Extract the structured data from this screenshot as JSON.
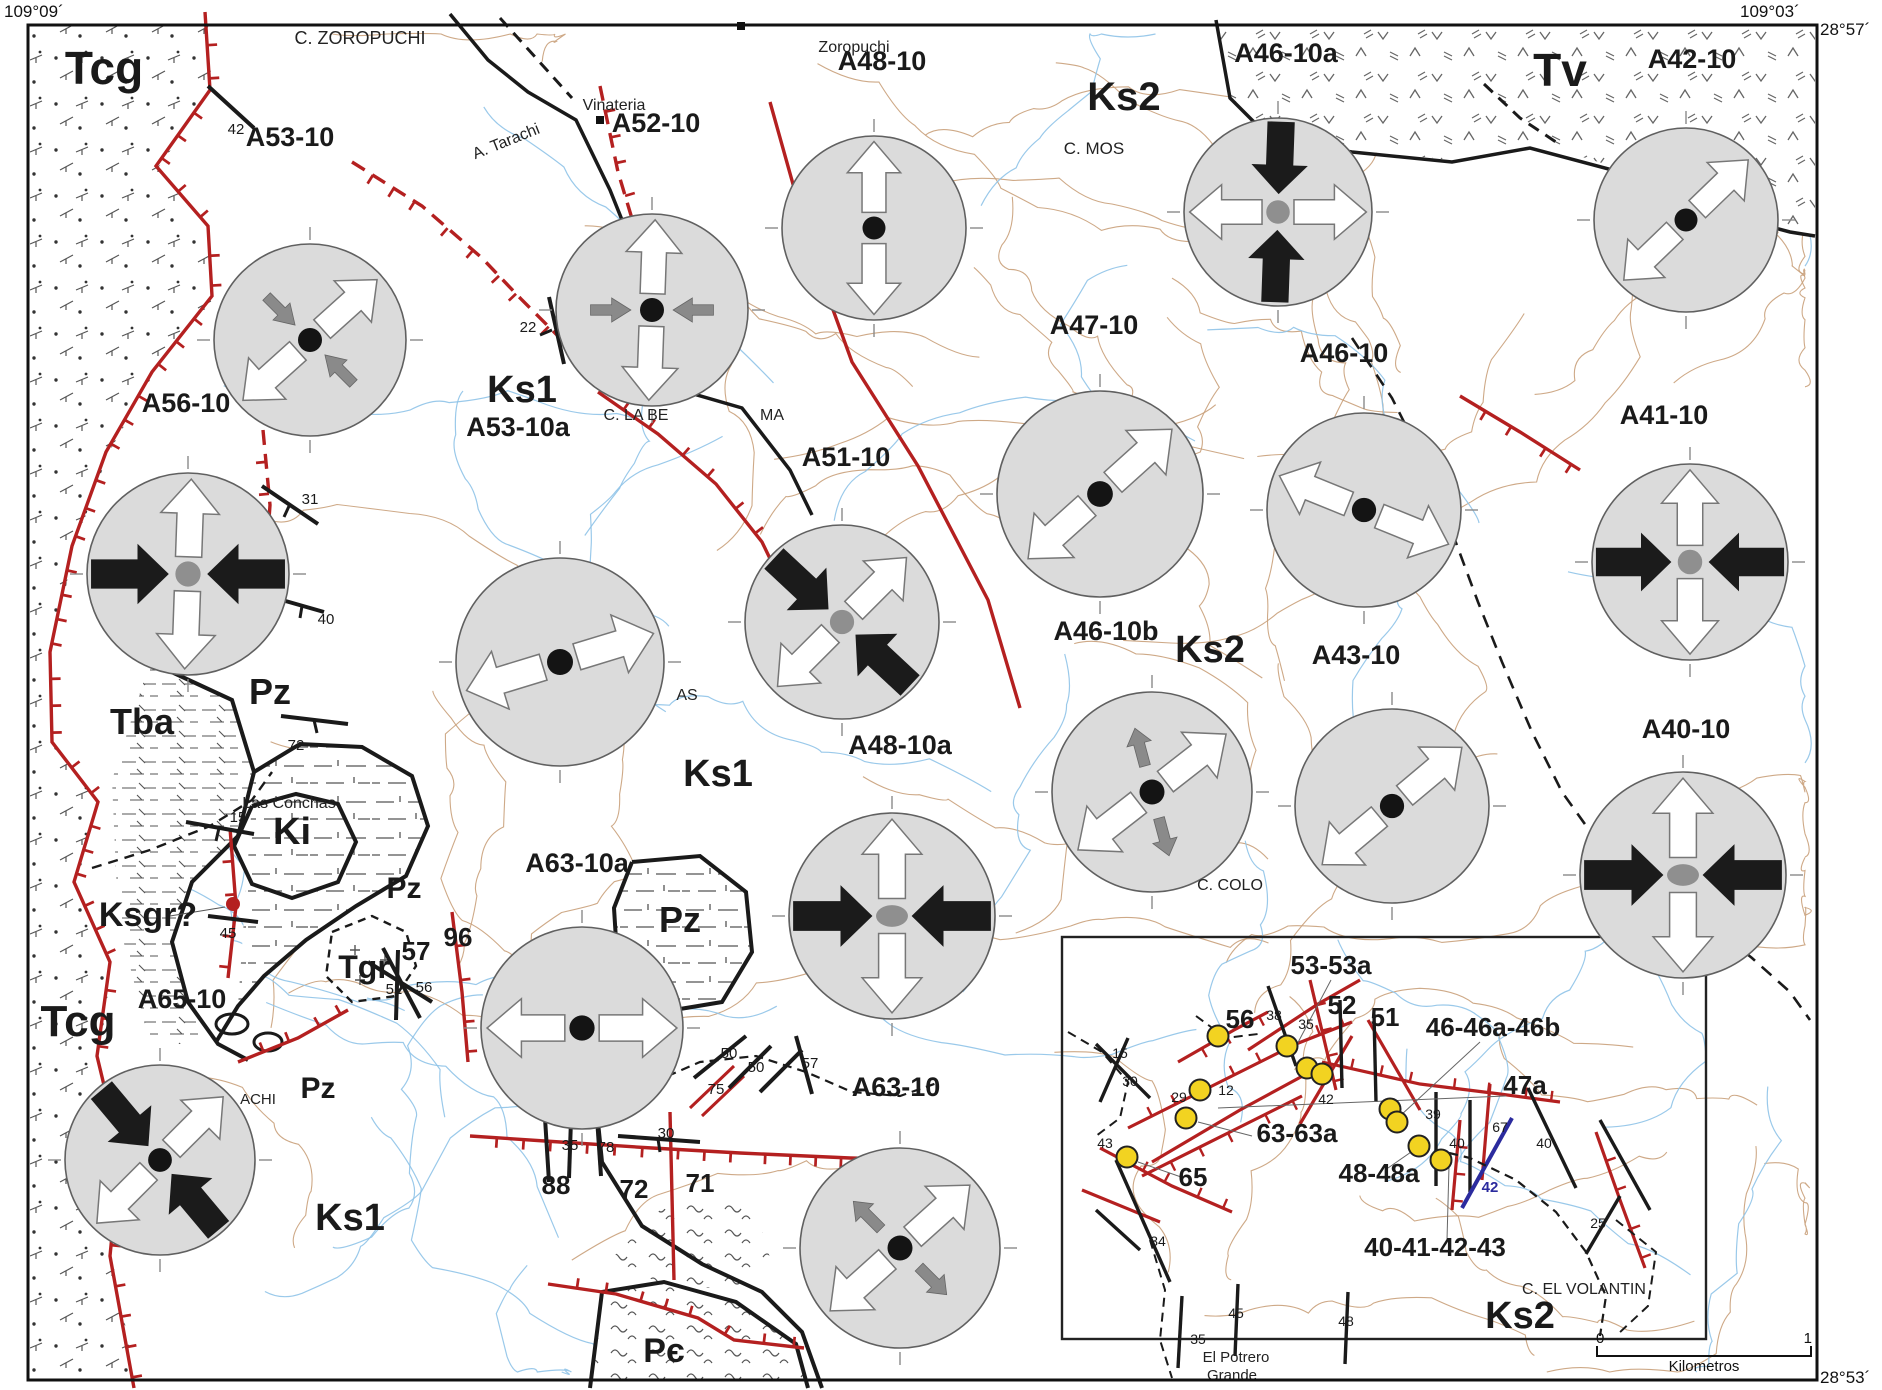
{
  "corners": {
    "top_left_lon": "109°09´",
    "top_right_lon": "109°03´",
    "top_right_lat": "28°57´",
    "bottom_right_lat": "28°53´"
  },
  "scale_bar": {
    "start": "0",
    "end": "1",
    "unit": "Kilometros"
  },
  "colors": {
    "fault_red": "#b42020",
    "contour": "#c9a07a",
    "stream": "#8fc3e8",
    "circle_fill": "#dbdbdb",
    "circle_stroke": "#606060",
    "arrow_black": "#1b1b1b",
    "arrow_gray": "#8a8a8a",
    "station_yellow": "#f2d321",
    "fault_blue": "#2b2b9e",
    "ink": "#1a1a1a"
  },
  "unit_labels": [
    {
      "t": "Tcg",
      "x": 104,
      "y": 84,
      "s": 46
    },
    {
      "t": "Tv",
      "x": 1560,
      "y": 86,
      "s": 46
    },
    {
      "t": "Ks2",
      "x": 1124,
      "y": 110,
      "s": 40
    },
    {
      "t": "Ks1",
      "x": 522,
      "y": 402,
      "s": 38
    },
    {
      "t": "Ks1",
      "x": 718,
      "y": 786,
      "s": 38
    },
    {
      "t": "Ks2",
      "x": 1210,
      "y": 662,
      "s": 38
    },
    {
      "t": "Pz",
      "x": 270,
      "y": 704,
      "s": 36
    },
    {
      "t": "Tba",
      "x": 142,
      "y": 734,
      "s": 36
    },
    {
      "t": "Ki",
      "x": 292,
      "y": 844,
      "s": 38
    },
    {
      "t": "Pz",
      "x": 404,
      "y": 898,
      "s": 30
    },
    {
      "t": "Ksgr?",
      "x": 148,
      "y": 926,
      "s": 34
    },
    {
      "t": "Tgr",
      "x": 364,
      "y": 978,
      "s": 32
    },
    {
      "t": "Pz",
      "x": 680,
      "y": 932,
      "s": 36
    },
    {
      "t": "Tcg",
      "x": 78,
      "y": 1036,
      "s": 44
    },
    {
      "t": "Pz",
      "x": 318,
      "y": 1098,
      "s": 30
    },
    {
      "t": "Ks1",
      "x": 350,
      "y": 1230,
      "s": 38
    },
    {
      "t": "Pє",
      "x": 664,
      "y": 1362,
      "s": 34
    }
  ],
  "place_labels": [
    {
      "t": "C. ZOROPUCHI",
      "x": 360,
      "y": 44,
      "s": 18
    },
    {
      "t": "Zoropuchi",
      "x": 854,
      "y": 52,
      "s": 16
    },
    {
      "t": "Vinateria",
      "x": 614,
      "y": 110,
      "s": 16
    },
    {
      "t": "A. Tarachi",
      "x": 508,
      "y": 146,
      "s": 16,
      "rot": -22
    },
    {
      "t": "C. MOS",
      "x": 1094,
      "y": 154,
      "s": 17
    },
    {
      "t": "C. LA BE",
      "x": 636,
      "y": 420,
      "s": 16
    },
    {
      "t": "MA",
      "x": 772,
      "y": 420,
      "s": 16
    },
    {
      "t": "AS",
      "x": 687,
      "y": 700,
      "s": 16
    },
    {
      "t": "Las Conchas",
      "x": 289,
      "y": 808,
      "s": 16
    },
    {
      "t": "C. COLO",
      "x": 1230,
      "y": 890,
      "s": 16
    },
    {
      "t": "ACHI",
      "x": 258,
      "y": 1104,
      "s": 15
    }
  ],
  "stations": [
    {
      "id": "A53-10",
      "lx": 290,
      "ly": 146,
      "cx": 310,
      "cy": 340,
      "r": 96,
      "white": 48,
      "gray": 135,
      "gray_dir": "in",
      "dot": "black"
    },
    {
      "id": "A52-10",
      "lx": 656,
      "ly": 132,
      "cx": 652,
      "cy": 310,
      "r": 96,
      "white": 2,
      "gray": 90,
      "gray_dir": "in",
      "dot": "black"
    },
    {
      "id": "A48-10",
      "lx": 882,
      "ly": 70,
      "cx": 874,
      "cy": 228,
      "r": 92,
      "white": 0,
      "dot": "black"
    },
    {
      "id": "A46-10a",
      "lx": 1286,
      "ly": 62,
      "cx": 1278,
      "cy": 212,
      "r": 94,
      "white": 90,
      "black": 2,
      "dot": "gray"
    },
    {
      "id": "A42-10",
      "lx": 1692,
      "ly": 68,
      "cx": 1686,
      "cy": 220,
      "r": 92,
      "white": 46,
      "dot": "black"
    },
    {
      "id": "A56-10",
      "lx": 186,
      "ly": 412,
      "cx": 188,
      "cy": 574,
      "r": 101,
      "white": 2,
      "black": 90,
      "dot": "gray"
    },
    {
      "id": "A53-10a",
      "lx": 518,
      "ly": 436,
      "cx": 560,
      "cy": 662,
      "r": 104,
      "white": 73,
      "dot": "black"
    },
    {
      "id": "A51-10",
      "lx": 846,
      "ly": 466,
      "cx": 842,
      "cy": 622,
      "r": 97,
      "white": 45,
      "black": 133,
      "dot": "gray"
    },
    {
      "id": "A47-10",
      "lx": 1094,
      "ly": 334,
      "cx": 1100,
      "cy": 494,
      "r": 103,
      "white": 48,
      "dot": "black"
    },
    {
      "id": "A46-10",
      "lx": 1344,
      "ly": 362,
      "cx": 1364,
      "cy": 510,
      "r": 97,
      "white": 112,
      "dot": "black"
    },
    {
      "id": "A41-10",
      "lx": 1664,
      "ly": 424,
      "cx": 1690,
      "cy": 562,
      "r": 98,
      "white": 0,
      "black": 90,
      "dot": "gray"
    },
    {
      "id": "A46-10b",
      "lx": 1106,
      "ly": 640,
      "cx": 1152,
      "cy": 792,
      "r": 100,
      "white": 52,
      "gray": 165,
      "gray_dir": "out",
      "dot": "black"
    },
    {
      "id": "A43-10",
      "lx": 1356,
      "ly": 664,
      "cx": 1392,
      "cy": 806,
      "r": 97,
      "white": 50,
      "dot": "black"
    },
    {
      "id": "A40-10",
      "lx": 1686,
      "ly": 738,
      "cx": 1683,
      "cy": 875,
      "r": 103,
      "white": 0,
      "black": 90,
      "dot": "grayoval"
    },
    {
      "id": "A48-10a",
      "lx": 900,
      "ly": 754,
      "cx": 892,
      "cy": 916,
      "r": 103,
      "white": 0,
      "black": 90,
      "dot": "grayoval"
    },
    {
      "id": "A63-10a",
      "lx": 577,
      "ly": 872,
      "cx": 582,
      "cy": 1028,
      "r": 101,
      "white": 90,
      "dot": "black"
    },
    {
      "id": "A65-10",
      "lx": 182,
      "ly": 1008,
      "cx": 160,
      "cy": 1160,
      "r": 95,
      "white": 45,
      "black": 140,
      "dot": "black"
    },
    {
      "id": "A63-10",
      "lx": 896,
      "ly": 1096,
      "cx": 900,
      "cy": 1248,
      "r": 100,
      "white": 48,
      "gray": 135,
      "gray_dir": "out",
      "dot": "black"
    }
  ],
  "big_numbers": [
    {
      "t": "57",
      "x": 416,
      "y": 960
    },
    {
      "t": "96",
      "x": 458,
      "y": 946
    },
    {
      "t": "88",
      "x": 556,
      "y": 1194
    },
    {
      "t": "72",
      "x": 634,
      "y": 1198
    },
    {
      "t": "71",
      "x": 700,
      "y": 1192
    }
  ],
  "small_numbers": [
    {
      "t": "42",
      "x": 236,
      "y": 134
    },
    {
      "t": "22",
      "x": 528,
      "y": 332
    },
    {
      "t": "31",
      "x": 310,
      "y": 504
    },
    {
      "t": "40",
      "x": 326,
      "y": 624
    },
    {
      "t": "72",
      "x": 296,
      "y": 750
    },
    {
      "t": "15",
      "x": 238,
      "y": 822
    },
    {
      "t": "45",
      "x": 228,
      "y": 938
    },
    {
      "t": "52",
      "x": 394,
      "y": 994
    },
    {
      "t": "56",
      "x": 424,
      "y": 992
    },
    {
      "t": "35",
      "x": 570,
      "y": 1150
    },
    {
      "t": "78",
      "x": 606,
      "y": 1152
    },
    {
      "t": "30",
      "x": 666,
      "y": 1138
    },
    {
      "t": "75",
      "x": 716,
      "y": 1094
    },
    {
      "t": "50",
      "x": 729,
      "y": 1058
    },
    {
      "t": "50",
      "x": 756,
      "y": 1072
    },
    {
      "t": "57",
      "x": 810,
      "y": 1068
    }
  ],
  "bottom_numbers": [
    {
      "t": "45",
      "x": 1236,
      "y": 1318
    },
    {
      "t": "48",
      "x": 1346,
      "y": 1326
    },
    {
      "t": "35",
      "x": 1198,
      "y": 1344
    }
  ],
  "bottom_places": [
    {
      "t": "El Potrero",
      "x": 1236,
      "y": 1362
    },
    {
      "t": "Grande",
      "x": 1232,
      "y": 1380
    }
  ],
  "map_marks": {
    "red_dot": {
      "x": 233,
      "y": 904
    },
    "town_squares": [
      [
        600,
        120
      ],
      [
        741,
        26
      ]
    ]
  },
  "inset": {
    "x": 1062,
    "y": 937,
    "w": 644,
    "h": 402,
    "labels": [
      {
        "t": "53-53a",
        "x": 1331,
        "y": 974
      },
      {
        "t": "56",
        "x": 1240,
        "y": 1028
      },
      {
        "t": "52",
        "x": 1342,
        "y": 1014
      },
      {
        "t": "51",
        "x": 1385,
        "y": 1026
      },
      {
        "t": "46-46a-46b",
        "x": 1493,
        "y": 1036
      },
      {
        "t": "47a",
        "x": 1525,
        "y": 1094
      },
      {
        "t": "63-63a",
        "x": 1297,
        "y": 1142
      },
      {
        "t": "48-48a",
        "x": 1379,
        "y": 1182
      },
      {
        "t": "65",
        "x": 1193,
        "y": 1186
      },
      {
        "t": "40-41-42-43",
        "x": 1435,
        "y": 1256
      }
    ],
    "numbers": [
      {
        "t": "15",
        "x": 1120,
        "y": 1058
      },
      {
        "t": "30",
        "x": 1130,
        "y": 1086
      },
      {
        "t": "38",
        "x": 1274,
        "y": 1020
      },
      {
        "t": "35",
        "x": 1306,
        "y": 1029
      },
      {
        "t": "12",
        "x": 1226,
        "y": 1095
      },
      {
        "t": "29",
        "x": 1179,
        "y": 1102
      },
      {
        "t": "42",
        "x": 1326,
        "y": 1104
      },
      {
        "t": "39",
        "x": 1433,
        "y": 1119
      },
      {
        "t": "40",
        "x": 1457,
        "y": 1148
      },
      {
        "t": "67",
        "x": 1500,
        "y": 1132
      },
      {
        "t": "40",
        "x": 1544,
        "y": 1148
      },
      {
        "t": "25",
        "x": 1598,
        "y": 1228
      },
      {
        "t": "43",
        "x": 1105,
        "y": 1148
      },
      {
        "t": "34",
        "x": 1158,
        "y": 1246
      }
    ],
    "blue_number": {
      "t": "42",
      "x": 1490,
      "y": 1192
    },
    "station_dots": [
      [
        1218,
        1036
      ],
      [
        1287,
        1046
      ],
      [
        1307,
        1068
      ],
      [
        1322,
        1074
      ],
      [
        1200,
        1090
      ],
      [
        1186,
        1118
      ],
      [
        1390,
        1109
      ],
      [
        1397,
        1122
      ],
      [
        1419,
        1146
      ],
      [
        1441,
        1160
      ],
      [
        1127,
        1157
      ]
    ],
    "unit_label": {
      "t": "Ks2",
      "x": 1520,
      "y": 1328,
      "s": 38
    },
    "place_label": {
      "t": "C. EL VOLANTIN",
      "x": 1584,
      "y": 1294,
      "s": 16
    }
  }
}
